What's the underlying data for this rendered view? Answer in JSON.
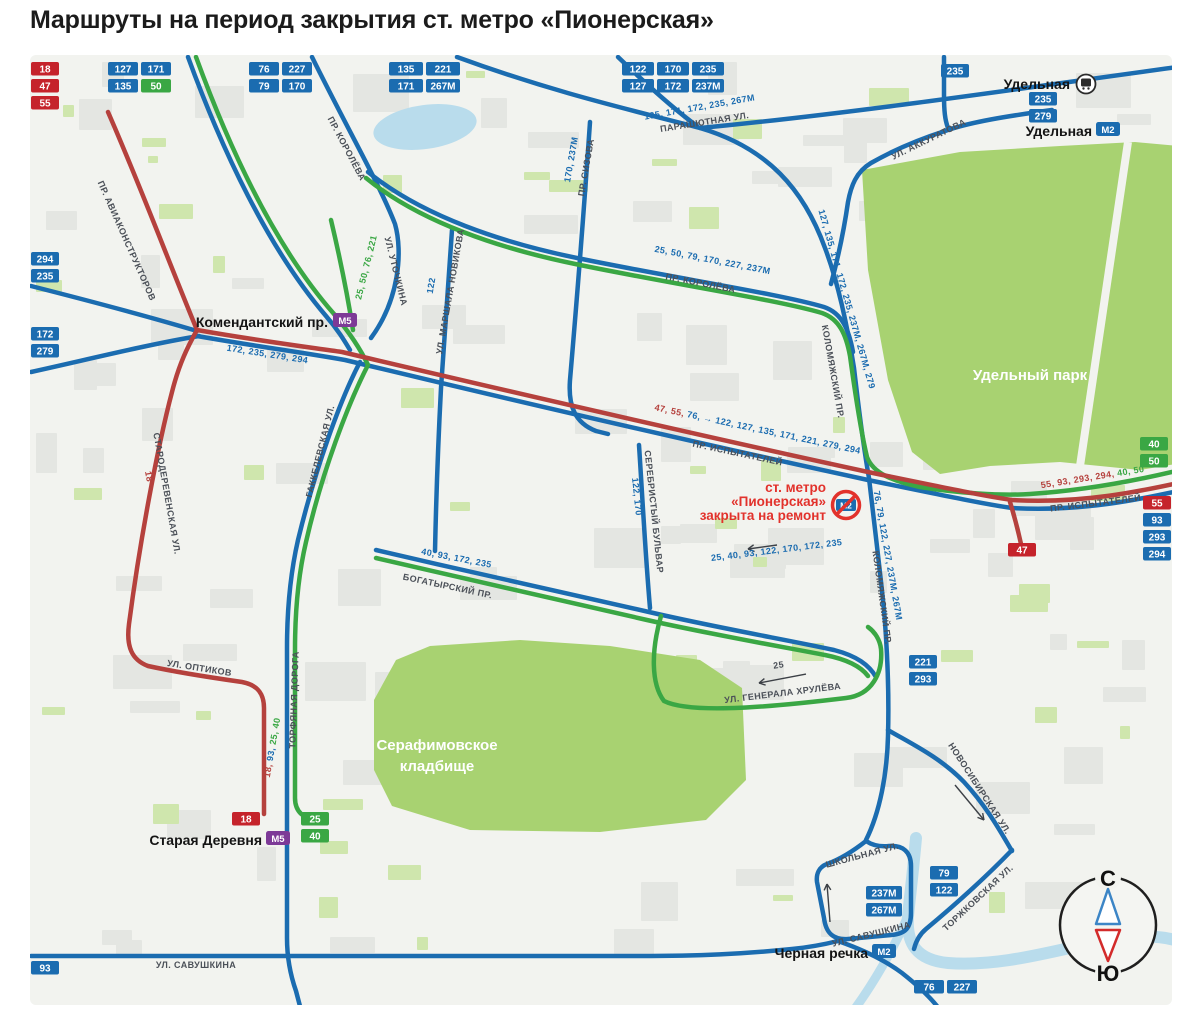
{
  "title": "Маршруты на период закрытия ст. метро «Пионерская»",
  "colors": {
    "blue": "#1b6cb0",
    "green": "#3aa744",
    "red_badge": "#c5232b",
    "red_route": "#b5413d",
    "purple": "#7d3a97",
    "label": "#4b5058",
    "closed_red": "#e2322c",
    "park": "#a8d271",
    "water": "#b9dcec",
    "building": "#e4e6e2",
    "patch": "#cfe6ad",
    "bg": "#f2f3ef"
  },
  "badge_groups": [
    {
      "x": 31,
      "y": 62,
      "cols": 1,
      "cw": 28,
      "items": [
        {
          "label": "18",
          "c": "red"
        },
        {
          "label": "47",
          "c": "red"
        },
        {
          "label": "55",
          "c": "red"
        }
      ]
    },
    {
      "x": 108,
      "y": 62,
      "cols": 2,
      "cw": 30,
      "items": [
        {
          "label": "127",
          "c": "blue"
        },
        {
          "label": "171",
          "c": "blue"
        },
        {
          "label": "135",
          "c": "blue"
        },
        {
          "label": "50",
          "c": "green"
        }
      ]
    },
    {
      "x": 249,
      "y": 62,
      "cols": 2,
      "cw": 30,
      "items": [
        {
          "label": "76",
          "c": "blue"
        },
        {
          "label": "227",
          "c": "blue"
        },
        {
          "label": "79",
          "c": "blue"
        },
        {
          "label": "170",
          "c": "blue"
        }
      ]
    },
    {
      "x": 389,
      "y": 62,
      "cols": 2,
      "cw": 34,
      "items": [
        {
          "label": "135",
          "c": "blue"
        },
        {
          "label": "221",
          "c": "blue"
        },
        {
          "label": "171",
          "c": "blue"
        },
        {
          "label": "267М",
          "c": "blue"
        }
      ]
    },
    {
      "x": 622,
      "y": 62,
      "cols": 3,
      "cw": 32,
      "items": [
        {
          "label": "122",
          "c": "blue"
        },
        {
          "label": "170",
          "c": "blue"
        },
        {
          "label": "235",
          "c": "blue"
        },
        {
          "label": "127",
          "c": "blue"
        },
        {
          "label": "172",
          "c": "blue"
        },
        {
          "label": "237М",
          "c": "blue"
        }
      ]
    },
    {
      "x": 941,
      "y": 64,
      "cols": 1,
      "cw": 28,
      "items": [
        {
          "label": "235",
          "c": "blue"
        }
      ]
    },
    {
      "x": 1029,
      "y": 92,
      "cols": 1,
      "cw": 28,
      "items": [
        {
          "label": "235",
          "c": "blue"
        },
        {
          "label": "279",
          "c": "blue"
        }
      ]
    },
    {
      "x": 31,
      "y": 252,
      "cols": 1,
      "cw": 28,
      "items": [
        {
          "label": "294",
          "c": "blue"
        },
        {
          "label": "235",
          "c": "blue"
        }
      ]
    },
    {
      "x": 31,
      "y": 327,
      "cols": 1,
      "cw": 28,
      "items": [
        {
          "label": "172",
          "c": "blue"
        },
        {
          "label": "279",
          "c": "blue"
        }
      ]
    },
    {
      "x": 1140,
      "y": 437,
      "cols": 1,
      "cw": 28,
      "items": [
        {
          "label": "40",
          "c": "green"
        },
        {
          "label": "50",
          "c": "green"
        }
      ]
    },
    {
      "x": 1143,
      "y": 496,
      "cols": 1,
      "cw": 28,
      "items": [
        {
          "label": "55",
          "c": "red"
        },
        {
          "label": "93",
          "c": "blue"
        },
        {
          "label": "293",
          "c": "blue"
        },
        {
          "label": "294",
          "c": "blue"
        }
      ]
    },
    {
      "x": 1008,
      "y": 543,
      "cols": 1,
      "cw": 28,
      "items": [
        {
          "label": "47",
          "c": "red"
        }
      ]
    },
    {
      "x": 909,
      "y": 655,
      "cols": 1,
      "cw": 28,
      "items": [
        {
          "label": "221",
          "c": "blue"
        },
        {
          "label": "293",
          "c": "blue"
        }
      ]
    },
    {
      "x": 232,
      "y": 812,
      "cols": 1,
      "cw": 28,
      "items": [
        {
          "label": "18",
          "c": "red"
        }
      ]
    },
    {
      "x": 301,
      "y": 812,
      "cols": 1,
      "cw": 28,
      "items": [
        {
          "label": "25",
          "c": "green"
        },
        {
          "label": "40",
          "c": "green"
        }
      ]
    },
    {
      "x": 866,
      "y": 886,
      "cols": 1,
      "cw": 36,
      "items": [
        {
          "label": "237М",
          "c": "blue"
        },
        {
          "label": "267М",
          "c": "blue"
        }
      ]
    },
    {
      "x": 930,
      "y": 866,
      "cols": 1,
      "cw": 28,
      "items": [
        {
          "label": "79",
          "c": "blue"
        },
        {
          "label": "122",
          "c": "blue"
        }
      ]
    },
    {
      "x": 914,
      "y": 980,
      "cols": 2,
      "cw": 30,
      "items": [
        {
          "label": "76",
          "c": "blue"
        },
        {
          "label": "227",
          "c": "blue"
        }
      ]
    },
    {
      "x": 31,
      "y": 961,
      "cols": 1,
      "cw": 28,
      "items": [
        {
          "label": "93",
          "c": "blue"
        }
      ]
    }
  ],
  "stations": [
    {
      "name": "Комендантский пр.",
      "badge": "М5",
      "type": "m5",
      "tx": 328,
      "ty": 327,
      "bx": 333,
      "by": 313
    },
    {
      "name": "Старая Деревня",
      "badge": "М5",
      "type": "m5",
      "tx": 262,
      "ty": 845,
      "bx": 266,
      "by": 831
    },
    {
      "name": "Удельная",
      "badge": "",
      "type": "rail",
      "tx": 1070,
      "ty": 89,
      "bx": 1086,
      "by": 84
    },
    {
      "name": "Удельная",
      "badge": "М2",
      "type": "m2",
      "tx": 1092,
      "ty": 136,
      "bx": 1096,
      "by": 122
    },
    {
      "name": "Черная речка",
      "badge": "М2",
      "type": "m2",
      "tx": 868,
      "ty": 958,
      "bx": 872,
      "by": 944
    }
  ],
  "closure": {
    "lines": [
      "ст. метро",
      "«Пионерская»",
      "закрыта на ремонт"
    ],
    "badge": "М2"
  },
  "street_labels": [
    {
      "t": "ПР. КОРОЛЁВА",
      "x": 344,
      "y": 150,
      "r": 62
    },
    {
      "t": "ПАРАШЮТНАЯ УЛ.",
      "x": 705,
      "y": 125,
      "r": -9
    },
    {
      "t": "ПР. СИЗОВА",
      "x": 589,
      "y": 168,
      "r": -80
    },
    {
      "t": "170, 237М",
      "x": 574,
      "y": 160,
      "r": -80,
      "c": "blue"
    },
    {
      "t": "УЛ. АККУРАТОВА",
      "x": 930,
      "y": 142,
      "r": -26
    },
    {
      "t": "ПР. АВИАКОНСТРУКТОРОВ",
      "x": 124,
      "y": 242,
      "r": 66
    },
    {
      "t": "УЛ. УТОЧКИНА",
      "x": 393,
      "y": 272,
      "r": 76
    },
    {
      "t": "25, 50, 76, 221",
      "x": 369,
      "y": 268,
      "r": -76,
      "c": "green"
    },
    {
      "t": "122",
      "x": 434,
      "y": 286,
      "r": -80,
      "c": "blue"
    },
    {
      "t": "УЛ. МАРШАЛА НОВИКОВА",
      "x": 453,
      "y": 292,
      "r": -80
    },
    {
      "t": "135, 171, 172, 235, 267М",
      "x": 700,
      "y": 110,
      "r": -10,
      "c": "blue"
    },
    {
      "t": "127, 135, 171, 172, 235, 237М, 267М, 279",
      "x": 844,
      "y": 300,
      "r": 74,
      "c": "blue"
    },
    {
      "t": "25, 50, 79, 170, 227, 237М",
      "x": 712,
      "y": 263,
      "r": 11,
      "c": "blue"
    },
    {
      "t": "ПР. КОРОЛЁВА",
      "x": 700,
      "y": 286,
      "r": 11
    },
    {
      "t": "КОЛОМЯЖСКИЙ ПР.",
      "x": 830,
      "y": 372,
      "r": 80
    },
    {
      "t": "КОЛОМЯЖСКИЙ ПР.",
      "x": 879,
      "y": 598,
      "r": 82
    },
    {
      "t": "172, 235, 279, 294",
      "x": 267,
      "y": 357,
      "r": 9,
      "c": "blue"
    },
    {
      "parts": [
        {
          "t": "47, 55, ",
          "c": "red"
        },
        {
          "t": "76, → 122, 127, 135, 171, 221, 279, 294",
          "c": "blue"
        }
      ],
      "x": 757,
      "y": 432,
      "r": 12
    },
    {
      "t": "ПР. ИСПЫТАТЕЛЕЙ",
      "x": 737,
      "y": 456,
      "r": 12
    },
    {
      "t": "ПР. ИСПЫТАТЕЛЕЙ",
      "x": 1096,
      "y": 506,
      "r": -7
    },
    {
      "parts": [
        {
          "t": "55, 93, 293, 294, ",
          "c": "red"
        },
        {
          "t": "40, 50",
          "c": "green"
        }
      ],
      "x": 1093,
      "y": 480,
      "r": -9
    },
    {
      "t": "СЕРЕБРИСТЫЙ БУЛЬВАР",
      "x": 651,
      "y": 512,
      "r": 84
    },
    {
      "t": "122, 170",
      "x": 634,
      "y": 497,
      "r": 84,
      "c": "blue"
    },
    {
      "t": "40, 93, 172, 235",
      "x": 456,
      "y": 561,
      "r": 11,
      "c": "blue"
    },
    {
      "t": "БОГАТЫРСКИЙ ПР.",
      "x": 447,
      "y": 589,
      "r": 12
    },
    {
      "t": "25, 40, 93, 122, 170, 172, 235",
      "x": 777,
      "y": 553,
      "r": -7,
      "c": "blue"
    },
    {
      "t": "76, 79, 122, 227, 237М, 267М",
      "x": 885,
      "y": 556,
      "r": 80,
      "c": "blue"
    },
    {
      "t": "18",
      "x": 146,
      "y": 477,
      "r": 80,
      "c": "red"
    },
    {
      "t": "СТАРОДЕРЕВЕНСКАЯ УЛ.",
      "x": 164,
      "y": 494,
      "r": 80
    },
    {
      "t": "ГАККЕЛЕВСКАЯ УЛ.",
      "x": 323,
      "y": 452,
      "r": -76
    },
    {
      "t": "ТОРФЯНАЯ ДОРОГА",
      "x": 297,
      "y": 700,
      "r": -88
    },
    {
      "parts": [
        {
          "t": "18, ",
          "c": "red"
        },
        {
          "t": "93, ",
          "c": "blue"
        },
        {
          "t": "25, 40",
          "c": "green"
        }
      ],
      "x": 275,
      "y": 748,
      "r": -80
    },
    {
      "t": "УЛ. ОПТИКОВ",
      "x": 199,
      "y": 671,
      "r": 9
    },
    {
      "t": "УЛ. ГЕНЕРАЛА ХРУЛЁВА",
      "x": 783,
      "y": 696,
      "r": -7
    },
    {
      "t": "25",
      "x": 779,
      "y": 668,
      "r": -8
    },
    {
      "t": "УЛ. САВУШКИНА",
      "x": 196,
      "y": 968,
      "r": 0
    },
    {
      "t": "УЛ. САВУШКИНА",
      "x": 872,
      "y": 937,
      "r": -14
    },
    {
      "t": "ШКОЛЬНАЯ УЛ.",
      "x": 863,
      "y": 858,
      "r": -15
    },
    {
      "t": "ТОРЖКОВСКАЯ УЛ.",
      "x": 980,
      "y": 900,
      "r": -43
    },
    {
      "t": "НОВОСИБИРСКАЯ УЛ.",
      "x": 977,
      "y": 790,
      "r": 57
    }
  ],
  "area_labels": [
    {
      "lines": [
        "Удельный парк"
      ],
      "x": 1030,
      "y": 380
    },
    {
      "lines": [
        "Серафимовское",
        "кладбище"
      ],
      "x": 437,
      "y": 750
    }
  ],
  "arrows": [
    {
      "x1": 806,
      "y1": 674,
      "x2": 759,
      "y2": 683
    },
    {
      "x1": 777,
      "y1": 545,
      "x2": 748,
      "y2": 549
    },
    {
      "x1": 955,
      "y1": 785,
      "x2": 984,
      "y2": 820
    },
    {
      "x1": 830,
      "y1": 922,
      "x2": 827,
      "y2": 884
    }
  ],
  "compass": {
    "north": "С",
    "south": "Ю"
  }
}
